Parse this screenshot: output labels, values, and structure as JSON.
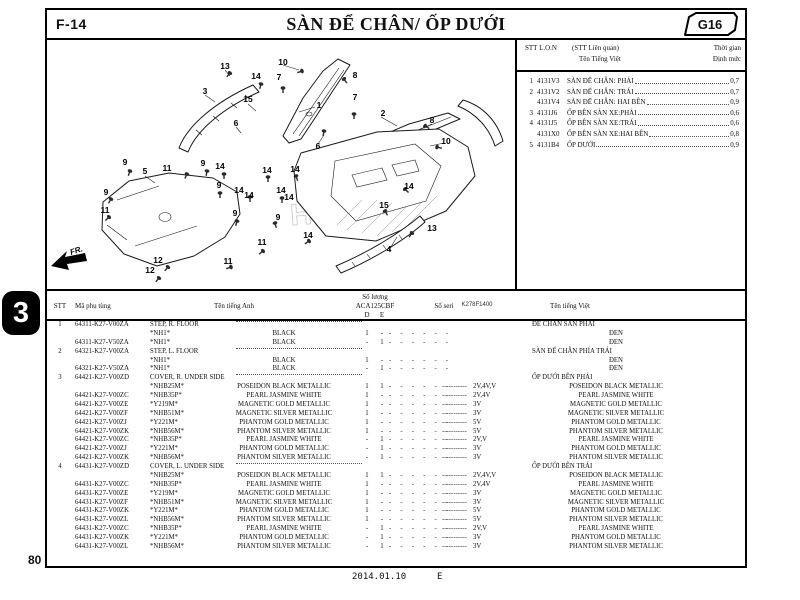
{
  "page": {
    "code": "F-14",
    "title": "SÀN ĐỂ CHÂN/ ỐP DƯỚI",
    "plate": "G16",
    "section_tab": "3",
    "page_number": "80",
    "footer_date": "2014.01.10",
    "footer_rev": "E",
    "diagram_code": "K278F1400",
    "fr_label": "FR."
  },
  "ref_table": {
    "header": {
      "col_stt": "STT L.O.N",
      "col_rel": "(STT Liên quan)",
      "col_time1": "Thời gian",
      "col_name": "Tên Tiếng Việt",
      "col_time2": "Định mức"
    },
    "rows": [
      {
        "stt": "1",
        "code": "4131V3",
        "name": "SÀN ĐỂ CHÂN: PHẢI",
        "time": "0,7"
      },
      {
        "stt": "2",
        "code": "4131V2",
        "name": "SÀN ĐỂ CHÂN: TRÁI",
        "time": "0,7"
      },
      {
        "stt": "",
        "code": "4131V4",
        "name": "SÀN ĐỂ CHÂN: HAI BÊN",
        "time": "0,9"
      },
      {
        "stt": "3",
        "code": "4131J6",
        "name": "ỐP BÊN SÀN XE:PHẢI",
        "time": "0,6"
      },
      {
        "stt": "4",
        "code": "4131J5",
        "name": "ỐP BÊN SÀN XE:TRÁI",
        "time": "0,6"
      },
      {
        "stt": "",
        "code": "4131X0",
        "name": "ỐP BÊN SÀN XE:HAI BÊN",
        "time": "0,8"
      },
      {
        "stt": "5",
        "code": "4131B4",
        "name": "ỐP DƯỚI",
        "time": "0,9"
      }
    ]
  },
  "parts_table": {
    "header": {
      "stt": "STT",
      "code": "Mã phụ tùng",
      "name_en": "Tên tiếng Anh",
      "qty": "Số lượng",
      "model": "ACA125CBF",
      "d": "D",
      "e": "E",
      "seri": "Số seri",
      "name_vi": "Tên tiếng Việt"
    },
    "filler_dashes": "-   -   -   -   -   -",
    "filler_run": "-----------",
    "rows": [
      {
        "t": "part",
        "stt": "1",
        "code": "64311-K27-V00ZA",
        "en": "STEP, R. FLOOR",
        "vi": "ĐỂ CHÂN SÀN PHẢI"
      },
      {
        "t": "color",
        "code": "",
        "cc": "*NH1*",
        "en": "BLACK",
        "d": "1",
        "e": "-",
        "seri": "",
        "vi": "ĐEN"
      },
      {
        "t": "color",
        "code": "64311-K27-V50ZA",
        "cc": "*NH1*",
        "en": "BLACK",
        "d": "-",
        "e": "1",
        "seri": "",
        "vi": "ĐEN"
      },
      {
        "t": "part",
        "stt": "2",
        "code": "64321-K27-V00ZA",
        "en": "STEP, L. FLOOR",
        "vi": "SÀN ĐỂ CHÂN PHÍA TRÁI"
      },
      {
        "t": "color",
        "code": "",
        "cc": "*NH1*",
        "en": "BLACK",
        "d": "1",
        "e": "-",
        "seri": "",
        "vi": "ĐEN"
      },
      {
        "t": "color",
        "code": "64321-K27-V50ZA",
        "cc": "*NH1*",
        "en": "BLACK",
        "d": "-",
        "e": "1",
        "seri": "",
        "vi": "ĐEN"
      },
      {
        "t": "part",
        "stt": "3",
        "code": "64421-K27-V00ZD",
        "en": "COVER, R. UNDER SIDE",
        "vi": "ỐP DƯỚI BÊN PHẢI"
      },
      {
        "t": "color",
        "code": "",
        "cc": "*NHB25M*",
        "en": "POSEIDON BLACK METALLIC",
        "d": "1",
        "e": "1",
        "seri": "2V,4V,V",
        "vi": "POSEIDON BLACK METALLIC"
      },
      {
        "t": "color",
        "code": "64421-K27-V00ZC",
        "cc": "*NHB35P*",
        "en": "PEARL JASMINE WHITE",
        "d": "1",
        "e": "-",
        "seri": "2V,4V",
        "vi": "PEARL JASMINE WHITE"
      },
      {
        "t": "color",
        "code": "64421-K27-V00ZE",
        "cc": "*Y219M*",
        "en": "MAGNETIC GOLD METALLIC",
        "d": "1",
        "e": "-",
        "seri": "3V",
        "vi": "MAGNETIC GOLD METALLIC"
      },
      {
        "t": "color",
        "code": "64421-K27-V00ZF",
        "cc": "*NHB51M*",
        "en": "MAGNETIC SILVER METALLIC",
        "d": "1",
        "e": "-",
        "seri": "3V",
        "vi": "MAGNETIC SILVER METALLIC"
      },
      {
        "t": "color",
        "code": "64421-K27-V00ZJ",
        "cc": "*Y221M*",
        "en": "PHANTOM GOLD METALLIC",
        "d": "1",
        "e": "-",
        "seri": "5V",
        "vi": "PHANTOM GOLD METALLIC"
      },
      {
        "t": "color",
        "code": "64421-K27-V00ZK",
        "cc": "*NHB56M*",
        "en": "PHANTOM SILVER METALLIC",
        "d": "1",
        "e": "-",
        "seri": "5V",
        "vi": "PHANTOM SILVER METALLIC"
      },
      {
        "t": "color",
        "code": "64421-K27-V00ZC",
        "cc": "*NHB35P*",
        "en": "PEARL JASMINE WHITE",
        "d": "-",
        "e": "1",
        "seri": "2V,V",
        "vi": "PEARL JASMINE WHITE"
      },
      {
        "t": "color",
        "code": "64421-K27-V00ZJ",
        "cc": "*Y221M*",
        "en": "PHANTOM GOLD METALLIC",
        "d": "-",
        "e": "1",
        "seri": "3V",
        "vi": "PHANTOM GOLD METALLIC"
      },
      {
        "t": "color",
        "code": "64421-K27-V00ZK",
        "cc": "*NHB56M*",
        "en": "PHANTOM SILVER METALLIC",
        "d": "-",
        "e": "1",
        "seri": "3V",
        "vi": "PHANTOM SILVER METALLIC"
      },
      {
        "t": "part",
        "stt": "4",
        "code": "64431-K27-V00ZD",
        "en": "COVER, L. UNDER SIDE",
        "vi": "ỐP DƯỚI BÊN TRÁI"
      },
      {
        "t": "color",
        "code": "",
        "cc": "*NHB25M*",
        "en": "POSEIDON BLACK METALLIC",
        "d": "1",
        "e": "1",
        "seri": "2V,4V,V",
        "vi": "POSEIDON BLACK METALLIC"
      },
      {
        "t": "color",
        "code": "64431-K27-V00ZC",
        "cc": "*NHB35P*",
        "en": "PEARL JASMINE WHITE",
        "d": "1",
        "e": "-",
        "seri": "2V,4V",
        "vi": "PEARL JASMINE WHITE"
      },
      {
        "t": "color",
        "code": "64431-K27-V00ZE",
        "cc": "*Y219M*",
        "en": "MAGNETIC GOLD METALLIC",
        "d": "1",
        "e": "-",
        "seri": "3V",
        "vi": "MAGNETIC GOLD METALLIC"
      },
      {
        "t": "color",
        "code": "64431-K27-V00ZF",
        "cc": "*NHB51M*",
        "en": "MAGNETIC SILVER METALLIC",
        "d": "1",
        "e": "-",
        "seri": "3V",
        "vi": "MAGNETIC SILVER METALLIC"
      },
      {
        "t": "color",
        "code": "64431-K27-V00ZK",
        "cc": "*Y221M*",
        "en": "PHANTOM GOLD METALLIC",
        "d": "1",
        "e": "-",
        "seri": "5V",
        "vi": "PHANTOM GOLD METALLIC"
      },
      {
        "t": "color",
        "code": "64431-K27-V00ZL",
        "cc": "*NHB56M*",
        "en": "PHANTOM SILVER METALLIC",
        "d": "1",
        "e": "-",
        "seri": "5V",
        "vi": "PHANTOM SILVER METALLIC"
      },
      {
        "t": "color",
        "code": "64431-K27-V00ZC",
        "cc": "*NHB35P*",
        "en": "PEARL JASMINE WHITE",
        "d": "-",
        "e": "1",
        "seri": "2V,V",
        "vi": "PEARL JASMINE WHITE"
      },
      {
        "t": "color",
        "code": "64431-K27-V00ZK",
        "cc": "*Y221M*",
        "en": "PHANTOM GOLD METALLIC",
        "d": "-",
        "e": "1",
        "seri": "3V",
        "vi": "PHANTOM GOLD METALLIC"
      },
      {
        "t": "color",
        "code": "64431-K27-V00ZL",
        "cc": "*NHB56M*",
        "en": "PHANTOM SILVER METALLIC",
        "d": "-",
        "e": "1",
        "seri": "3V",
        "vi": "PHANTOM SILVER METALLIC"
      }
    ]
  },
  "diagram": {
    "watermark": "HONDA",
    "callouts": [
      {
        "n": "13",
        "x": 178,
        "y": 56
      },
      {
        "n": "10",
        "x": 236,
        "y": 52
      },
      {
        "n": "14",
        "x": 209,
        "y": 66
      },
      {
        "n": "7",
        "x": 232,
        "y": 67
      },
      {
        "n": "8",
        "x": 308,
        "y": 65
      },
      {
        "n": "3",
        "x": 158,
        "y": 81
      },
      {
        "n": "15",
        "x": 201,
        "y": 89
      },
      {
        "n": "7",
        "x": 308,
        "y": 87
      },
      {
        "n": "1",
        "x": 272,
        "y": 95
      },
      {
        "n": "2",
        "x": 336,
        "y": 103
      },
      {
        "n": "8",
        "x": 385,
        "y": 110
      },
      {
        "n": "6",
        "x": 189,
        "y": 113
      },
      {
        "n": "10",
        "x": 399,
        "y": 131
      },
      {
        "n": "6",
        "x": 271,
        "y": 136
      },
      {
        "n": "9",
        "x": 78,
        "y": 152
      },
      {
        "n": "5",
        "x": 98,
        "y": 161
      },
      {
        "n": "11",
        "x": 120,
        "y": 158
      },
      {
        "n": "9",
        "x": 156,
        "y": 153
      },
      {
        "n": "14",
        "x": 173,
        "y": 156
      },
      {
        "n": "14",
        "x": 220,
        "y": 160
      },
      {
        "n": "14",
        "x": 248,
        "y": 159
      },
      {
        "n": "9",
        "x": 59,
        "y": 182
      },
      {
        "n": "9",
        "x": 172,
        "y": 175
      },
      {
        "n": "14",
        "x": 192,
        "y": 180
      },
      {
        "n": "14",
        "x": 202,
        "y": 185
      },
      {
        "n": "14",
        "x": 234,
        "y": 180
      },
      {
        "n": "14",
        "x": 242,
        "y": 187
      },
      {
        "n": "11",
        "x": 58,
        "y": 200
      },
      {
        "n": "9",
        "x": 188,
        "y": 203
      },
      {
        "n": "9",
        "x": 231,
        "y": 207
      },
      {
        "n": "15",
        "x": 337,
        "y": 195
      },
      {
        "n": "14",
        "x": 362,
        "y": 176
      },
      {
        "n": "11",
        "x": 215,
        "y": 232
      },
      {
        "n": "12",
        "x": 111,
        "y": 250
      },
      {
        "n": "12",
        "x": 103,
        "y": 260
      },
      {
        "n": "11",
        "x": 181,
        "y": 251
      },
      {
        "n": "13",
        "x": 385,
        "y": 218
      },
      {
        "n": "14",
        "x": 261,
        "y": 225
      },
      {
        "n": "4",
        "x": 342,
        "y": 239
      }
    ]
  }
}
